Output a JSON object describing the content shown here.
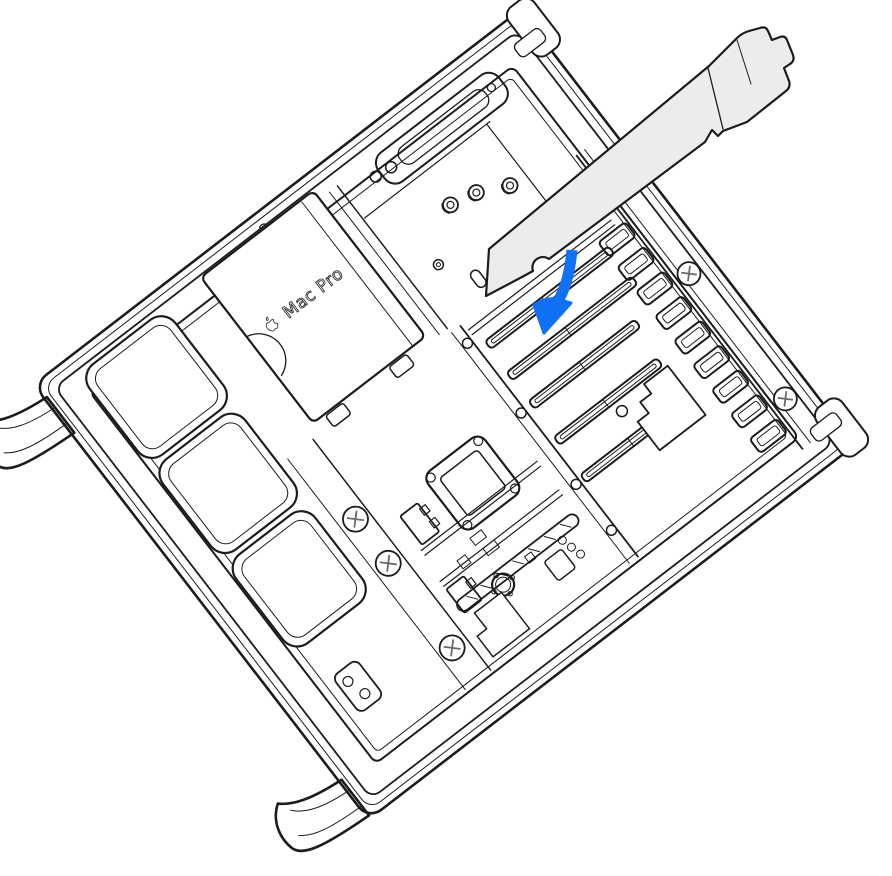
{
  "illustration": {
    "title": "Mac Pro opened on its side with a PCIe card being inserted into a PCIe slot",
    "device_label": "Mac Pro",
    "colors": {
      "line": "#1c1c1c",
      "card_fill": "#ececec",
      "arrow_blue": "#1171f5",
      "background": "#ffffff"
    },
    "icons": {
      "apple_logo": "apple-logo-icon",
      "insertion_arrow": "insertion-arrow-icon"
    },
    "parts": {
      "chassis": "mac-pro-chassis",
      "psu_cover": "power-supply-cover",
      "fans": "fan-modules",
      "cpu_socket": "cpu-socket",
      "battery": "coin-cell-battery",
      "pcie_slots": "pcie-slots",
      "vents": "bracket-vent-slots",
      "card": "pcie-card",
      "feet": "chassis-feet"
    }
  }
}
